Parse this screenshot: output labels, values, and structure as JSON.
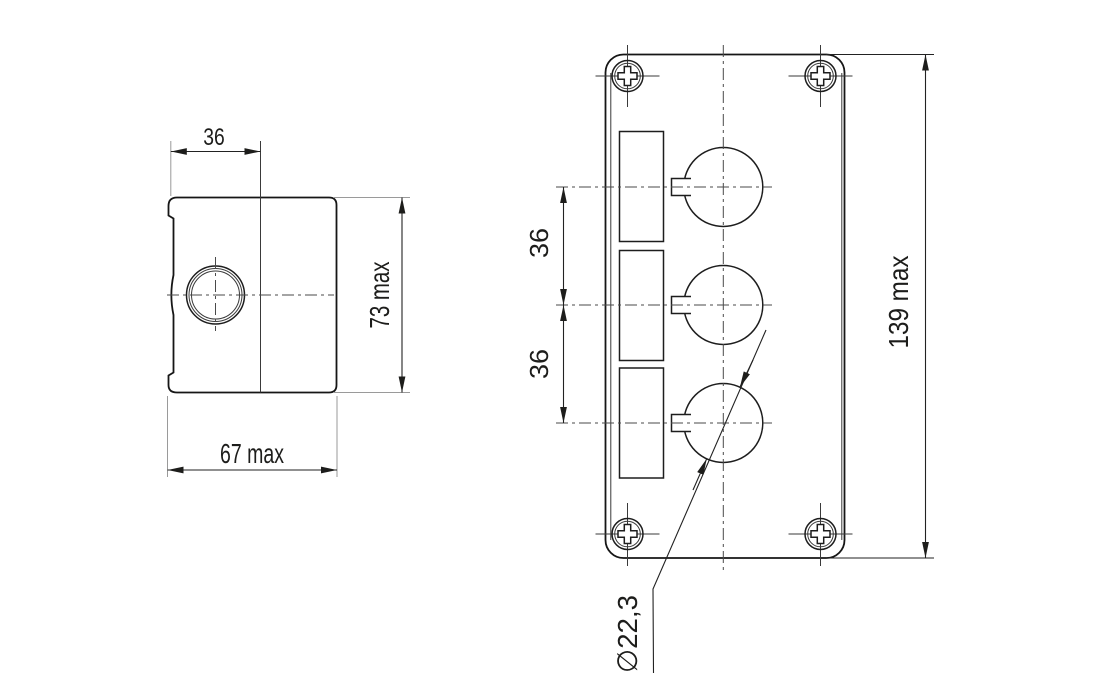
{
  "drawing": {
    "title": "pushbutton-enclosure-dimension-drawing",
    "side_view": {
      "top_width": "36",
      "overall_height": "73 max",
      "overall_width": "67 max"
    },
    "front_view": {
      "spacing_top": "36",
      "spacing_bottom": "36",
      "overall_height": "139 max",
      "hole_diameter": "∅22,3"
    },
    "colors": {
      "line": "#161616",
      "extension_line": "#9a9a9a",
      "background": "#ffffff"
    }
  }
}
